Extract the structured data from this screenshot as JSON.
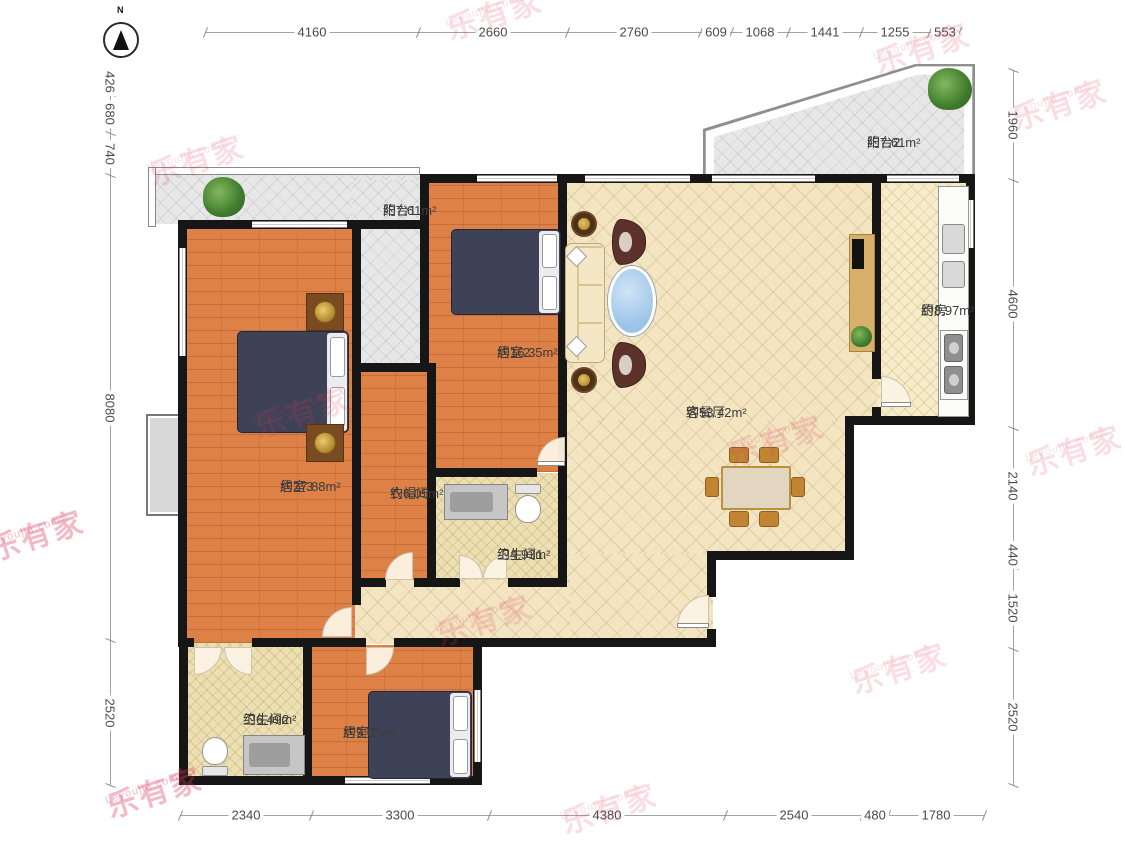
{
  "watermark": {
    "brand": "乐有家",
    "site": "Leyoujia.com®"
  },
  "compass": {
    "north_label": "N"
  },
  "rooms": {
    "balcony1": {
      "name": "阳台1",
      "area": "约7.61m²"
    },
    "balcony2": {
      "name": "阳台2",
      "area": "约7.61m²"
    },
    "bedroom2": {
      "name": "居室2",
      "area": "约16.35m²"
    },
    "bedroom3": {
      "name": "居室3",
      "area": "约27.88m²"
    },
    "cloakroom": {
      "name": "衣帽间",
      "area": "约6.05m²"
    },
    "bathroom1": {
      "name": "卫生间1",
      "area": "约4.93m²"
    },
    "bathroom2": {
      "name": "卫生间2",
      "area": "约6.49m²"
    },
    "bedroom1": {
      "name": "居室1",
      "area": "约9.03m²"
    },
    "living": {
      "name": "客餐厅",
      "area": "约53.42m²"
    },
    "kitchen": {
      "name": "厨房",
      "area": "约8.97m²"
    }
  },
  "dims": {
    "top": [
      "4160",
      "2660",
      "2760",
      "609",
      "1068",
      "1441",
      "1255",
      "553"
    ],
    "left": [
      "426",
      "680",
      "740",
      "8080",
      "2520"
    ],
    "right": [
      "1960",
      "4600",
      "2140",
      "440",
      "1520",
      "2520"
    ],
    "bottom": [
      "2340",
      "3300",
      "4380",
      "2540",
      "480",
      "1780"
    ]
  },
  "colors": {
    "wall": "#161616",
    "wood": "#dd8147",
    "tile": "#f3e4c2",
    "watermark": "#de3e5a"
  }
}
